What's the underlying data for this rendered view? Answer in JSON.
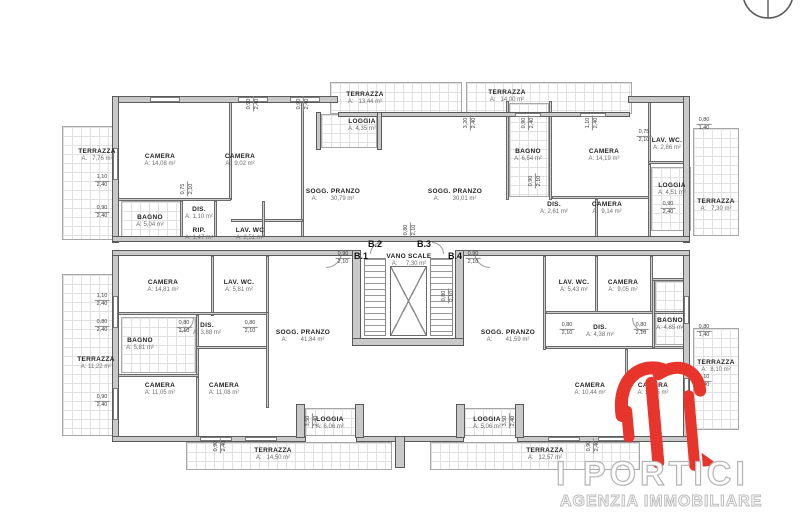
{
  "logo": {
    "title": "I PORTICI",
    "subtitle": "AGENZIA IMMOBILIARE"
  },
  "colors": {
    "wall": "#c9c9c9",
    "wall_edge": "#5a5a5a",
    "hatch_line": "#e1e1e1",
    "room_name": "#1f1f1f",
    "area_text": "#6e6e6e",
    "logo_red": "#e8352c",
    "logo_outline": "#b5b5b5"
  },
  "stair_core": {
    "name": "VANO SCALE",
    "area": "A:      7,30 m²"
  },
  "unit_labels": [
    {
      "text": "B.1",
      "x": 361,
      "y": 251
    },
    {
      "text": "B.2",
      "x": 375,
      "y": 239
    },
    {
      "text": "B.3",
      "x": 424,
      "y": 239
    },
    {
      "text": "B.4",
      "x": 455,
      "y": 251
    }
  ],
  "rooms": [
    {
      "name": "TERRAZZA",
      "area": "A.   7,76 m²",
      "x": 97,
      "y": 148
    },
    {
      "name": "CAMERA",
      "area": "A: 14,08 m²",
      "x": 160,
      "y": 153
    },
    {
      "name": "CAMERA",
      "area": "A:  9,02 m²",
      "x": 240,
      "y": 153
    },
    {
      "name": "BAGNO",
      "area": "A: 5,04 m²",
      "x": 150,
      "y": 214
    },
    {
      "name": "DIS.",
      "area": "A: 1,10 m²",
      "x": 199,
      "y": 206
    },
    {
      "name": "RIP.",
      "area": "A: 1,47 m²",
      "x": 199,
      "y": 227
    },
    {
      "name": "LAV. WC",
      "area": "A: 2,51 m²",
      "x": 250,
      "y": 227
    },
    {
      "name": "SOGG. PRANZO",
      "area": "A:        30,79 m²",
      "x": 333,
      "y": 188
    },
    {
      "name": "LOGGIA",
      "area": "A: 4,35 m²",
      "x": 362,
      "y": 118
    },
    {
      "name": "TERRAZZA",
      "area": "A:   13,44 m²",
      "x": 365,
      "y": 91
    },
    {
      "name": "TERRAZZA",
      "area": "A:   14,00 m²",
      "x": 507,
      "y": 89
    },
    {
      "name": "BAGNO",
      "area": "A: 6,54 m²",
      "x": 528,
      "y": 148
    },
    {
      "name": "CAMERA",
      "area": "A: 14,19 m²",
      "x": 604,
      "y": 148
    },
    {
      "name": "LAV. WC.",
      "area": "A: 2,86 m²",
      "x": 667,
      "y": 137
    },
    {
      "name": "SOGG. PRANZO",
      "area": "A:        30,01 m²",
      "x": 455,
      "y": 188
    },
    {
      "name": "DIS.",
      "area": "A: 2,61 m²",
      "x": 554,
      "y": 201
    },
    {
      "name": "CAMERA",
      "area": "A:  9,14 m²",
      "x": 607,
      "y": 201
    },
    {
      "name": "LOGGIA",
      "area": "A: 4,51 m²",
      "x": 672,
      "y": 182
    },
    {
      "name": "TERRAZZA",
      "area": "A:   7,30 m²",
      "x": 716,
      "y": 198
    },
    {
      "name": "VANO SCALE",
      "area": "A:     7,30 m²",
      "x": 409,
      "y": 253
    },
    {
      "name": "CAMERA",
      "area": "A: 14,81 m²",
      "x": 163,
      "y": 279
    },
    {
      "name": "LAV. WC.",
      "area": "A: 5,81 m²",
      "x": 239,
      "y": 279
    },
    {
      "name": "DIS.",
      "area": "A: 3,88 m²",
      "x": 207,
      "y": 322
    },
    {
      "name": "BAGNO",
      "area": "A: 5,81 m²",
      "x": 140,
      "y": 337
    },
    {
      "name": "CAMERA",
      "area": "A: 11,05 m²",
      "x": 160,
      "y": 382
    },
    {
      "name": "CAMERA",
      "area": "A: 11,08 m²",
      "x": 224,
      "y": 382
    },
    {
      "name": "SOGG. PRANZO",
      "area": "A:        41,84 m²",
      "x": 303,
      "y": 329
    },
    {
      "name": "LOGGIA",
      "area": "A: 6,06 m²",
      "x": 330,
      "y": 416
    },
    {
      "name": "TERRAZZA",
      "area": "A:   14,50 m²",
      "x": 273,
      "y": 447
    },
    {
      "name": "TERRAZZA",
      "area": "A: 11,22 m²",
      "x": 96,
      "y": 356
    },
    {
      "name": "SOGG. PRANZO",
      "area": "A:        41,59 m²",
      "x": 508,
      "y": 329
    },
    {
      "name": "LAV. WC.",
      "area": "A: 5,43 m²",
      "x": 574,
      "y": 279
    },
    {
      "name": "CAMERA",
      "area": "A:  9,05 m²",
      "x": 623,
      "y": 279
    },
    {
      "name": "DIS.",
      "area": "A: 4,38 m²",
      "x": 600,
      "y": 324
    },
    {
      "name": "BAGNO",
      "area": "A: 4,85 m²",
      "x": 670,
      "y": 317
    },
    {
      "name": "CAMERA",
      "area": "A: 10,44 m²",
      "x": 590,
      "y": 382
    },
    {
      "name": "CAMERA",
      "area": "A: 14,05 m²",
      "x": 653,
      "y": 382
    },
    {
      "name": "LOGGIA",
      "area": "A: 5,06 m²",
      "x": 487,
      "y": 416
    },
    {
      "name": "TERRAZZA",
      "area": "A:   12,57 m²",
      "x": 545,
      "y": 447
    },
    {
      "name": "TERRAZZA",
      "area": "A:  8,10 m²",
      "x": 716,
      "y": 359
    }
  ],
  "dims": [
    {
      "a": "1,10",
      "b": "2,40",
      "x": 102,
      "y": 181,
      "v": false
    },
    {
      "a": "0,90",
      "b": "2,40",
      "x": 102,
      "y": 212,
      "v": false
    },
    {
      "a": "1,10",
      "b": "2,40",
      "x": 102,
      "y": 300,
      "v": false
    },
    {
      "a": "0,80",
      "b": "2,40",
      "x": 102,
      "y": 326,
      "v": false
    },
    {
      "a": "0,90",
      "b": "2,40",
      "x": 102,
      "y": 401,
      "v": false
    },
    {
      "a": "0,90",
      "b": "2,40",
      "x": 253,
      "y": 104,
      "v": true
    },
    {
      "a": "0,90",
      "b": "2,40",
      "x": 303,
      "y": 104,
      "v": true
    },
    {
      "a": "3,20",
      "b": "2,40",
      "x": 470,
      "y": 123,
      "v": true
    },
    {
      "a": "0,90",
      "b": "2,40",
      "x": 528,
      "y": 123,
      "v": true
    },
    {
      "a": "1,10",
      "b": "2,40",
      "x": 592,
      "y": 123,
      "v": true
    },
    {
      "a": "0,75",
      "b": "2,10",
      "x": 644,
      "y": 136,
      "v": false
    },
    {
      "a": "0,80",
      "b": "1,40",
      "x": 704,
      "y": 124,
      "v": false
    },
    {
      "a": "0,90",
      "b": "2,40",
      "x": 668,
      "y": 208,
      "v": false
    },
    {
      "a": "0,90",
      "b": "2,10",
      "x": 343,
      "y": 258,
      "v": false
    },
    {
      "a": "0,90",
      "b": "2,10",
      "x": 473,
      "y": 258,
      "v": false
    },
    {
      "a": "0,80",
      "b": "2,10",
      "x": 184,
      "y": 327,
      "v": false
    },
    {
      "a": "0,80",
      "b": "2,10",
      "x": 250,
      "y": 327,
      "v": false
    },
    {
      "a": "0,80",
      "b": "2,10",
      "x": 567,
      "y": 329,
      "v": false
    },
    {
      "a": "0,80",
      "b": "2,10",
      "x": 641,
      "y": 329,
      "v": false
    },
    {
      "a": "3,50",
      "b": "2,40",
      "x": 312,
      "y": 421,
      "v": true
    },
    {
      "a": "3,50",
      "b": "2,40",
      "x": 509,
      "y": 421,
      "v": true
    },
    {
      "a": "0,90",
      "b": "2,40",
      "x": 220,
      "y": 446,
      "v": true
    },
    {
      "a": "0,90",
      "b": "2,40",
      "x": 593,
      "y": 446,
      "v": true
    },
    {
      "a": "0,80",
      "b": "1,40",
      "x": 704,
      "y": 331,
      "v": false
    },
    {
      "a": "1,10",
      "b": "2,40",
      "x": 704,
      "y": 381,
      "v": false
    },
    {
      "a": "0,75",
      "b": "2,10",
      "x": 187,
      "y": 189,
      "v": true
    },
    {
      "a": "0,90",
      "b": "2,10",
      "x": 535,
      "y": 181,
      "v": true
    },
    {
      "a": "0,80",
      "b": "2,10",
      "x": 410,
      "y": 230,
      "v": true
    },
    {
      "a": "0,80",
      "b": "2,10",
      "x": 448,
      "y": 296,
      "v": true
    }
  ]
}
